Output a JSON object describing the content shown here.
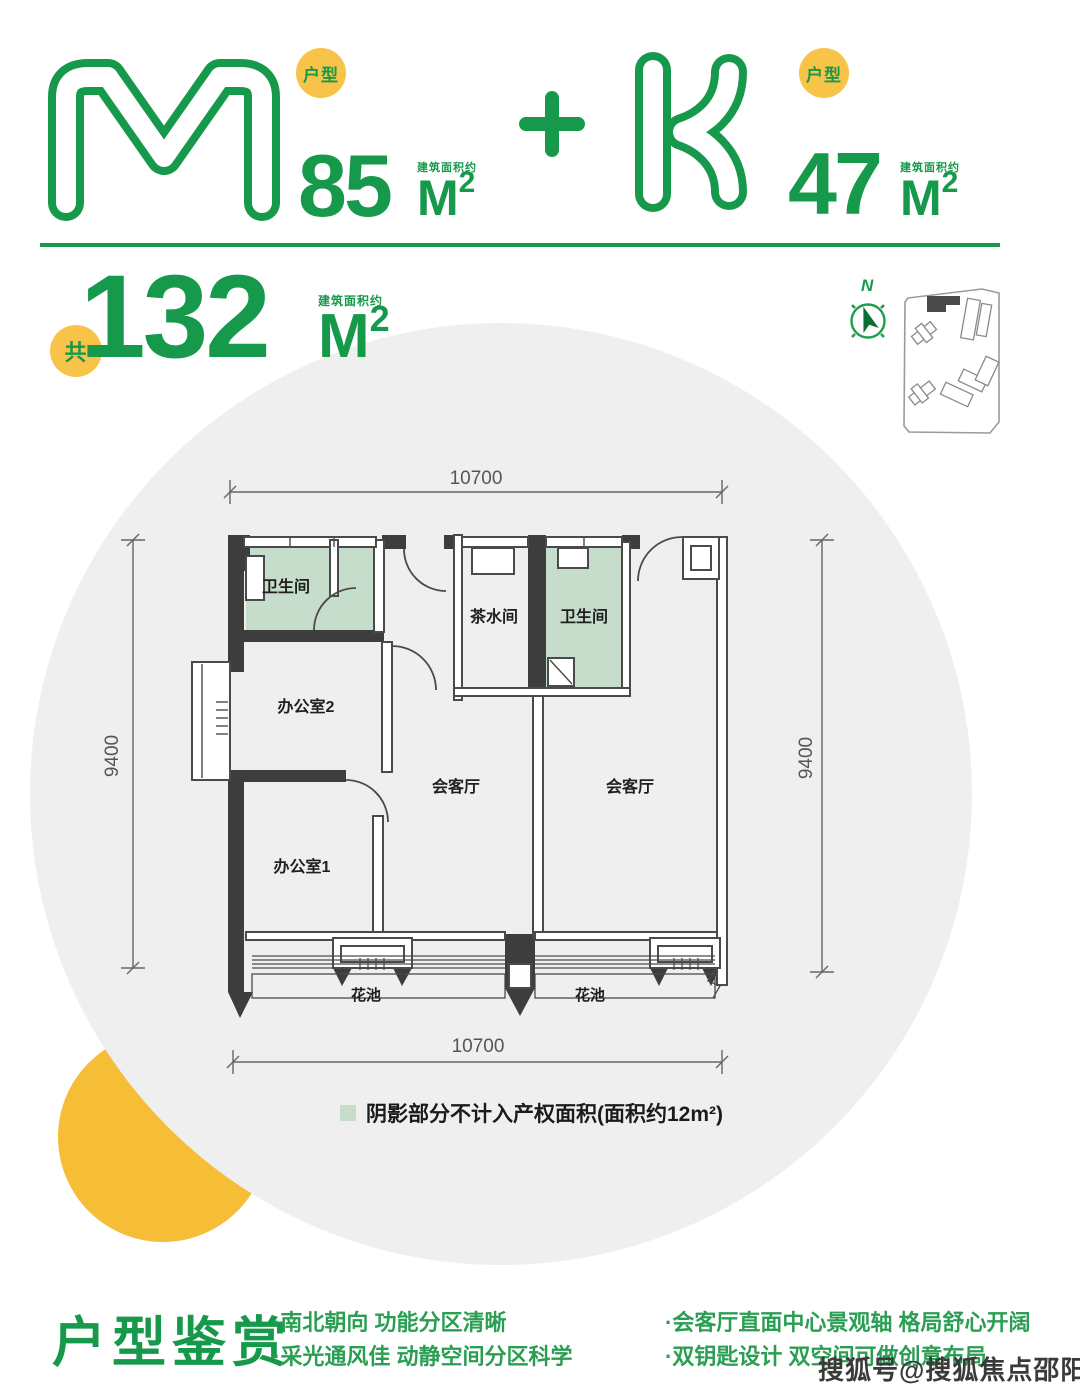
{
  "colors": {
    "green": "#16994a",
    "dark_green": "#0d6e35",
    "badge_yellow": "#f8c349",
    "crescent_yellow": "#f6bd37",
    "circle_gray": "#efefef",
    "wall_dark": "#3d3d3d",
    "shade_green": "#c7ddcc"
  },
  "header": {
    "unit_m": {
      "letter": "M",
      "badge": "户型",
      "area": "85",
      "area_note": "建筑面积约",
      "unit": "M",
      "sup": "2"
    },
    "plus": "+",
    "unit_k": {
      "letter": "K",
      "badge": "户型",
      "area": "47",
      "area_note": "建筑面积约",
      "unit": "M",
      "sup": "2"
    }
  },
  "total": {
    "badge": "共",
    "area": "132",
    "area_note": "建筑面积约",
    "unit": "M",
    "sup": "2"
  },
  "compass": {
    "north": "N"
  },
  "floorplan": {
    "dims": {
      "top": "10700",
      "bottom": "10700",
      "left": "9400",
      "right": "9400"
    },
    "rooms": {
      "bath1": "卫生间",
      "tea": "茶水间",
      "bath2": "卫生间",
      "office2": "办公室2",
      "office1": "办公室1",
      "meeting1": "会客厅",
      "meeting2": "会客厅",
      "flower1": "花池",
      "flower2": "花池"
    },
    "legend": "阴影部分不计入产权面积(面积约12m²)"
  },
  "features": {
    "title": "户型鉴赏",
    "col1": [
      "·南北朝向 功能分区清晰",
      "·采光通风佳 动静空间分区科学"
    ],
    "col2": [
      "·会客厅直面中心景观轴 格局舒心开阔",
      "·双钥匙设计 双空间可做创意布局"
    ]
  },
  "watermark": "搜狐号@搜狐焦点邵阳站"
}
